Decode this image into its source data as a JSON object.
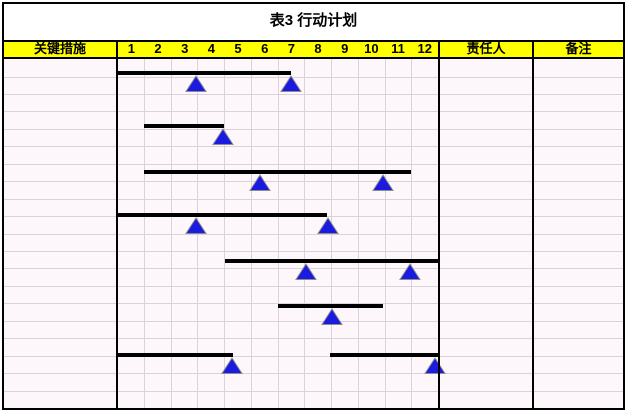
{
  "title": "表3 行动计划",
  "header": {
    "measures_label": "关键措施",
    "months": [
      "1",
      "2",
      "3",
      "4",
      "5",
      "6",
      "7",
      "8",
      "9",
      "10",
      "11",
      "12"
    ],
    "owner_label": "责任人",
    "notes_label": "备注"
  },
  "colors": {
    "header_bg": "#ffff00",
    "body_bg": "#fdf7fb",
    "grid_line": "#d9d2d9",
    "border": "#000000",
    "bar": "#000000",
    "triangle_fill": "#1a1ae0",
    "triangle_stroke": "#8c8c8c"
  },
  "chart_data": {
    "type": "gantt",
    "title": "表3 行动计划",
    "x_axis": {
      "tick_labels": [
        "1",
        "2",
        "3",
        "4",
        "5",
        "6",
        "7",
        "8",
        "9",
        "10",
        "11",
        "12"
      ],
      "range": [
        0,
        12
      ],
      "unit": "month"
    },
    "grid": "on",
    "tasks": [
      {
        "segments": [
          {
            "from": 0,
            "to": 6.5,
            "style": "solid"
          },
          {
            "from": 6.5,
            "to": 11.95,
            "style": "dashed"
          }
        ],
        "milestones": [
          2.95,
          6.5
        ],
        "y_px": 12
      },
      {
        "segments": [
          {
            "from": 1,
            "to": 4,
            "style": "solid"
          }
        ],
        "milestones": [
          3.95
        ],
        "y_px": 65
      },
      {
        "segments": [
          {
            "from": 1,
            "to": 11,
            "style": "solid"
          }
        ],
        "milestones": [
          5.35,
          9.95
        ],
        "y_px": 111
      },
      {
        "segments": [
          {
            "from": 0,
            "to": 7.85,
            "style": "solid"
          }
        ],
        "milestones": [
          2.95,
          7.9
        ],
        "y_px": 154
      },
      {
        "segments": [
          {
            "from": 4.05,
            "to": 12,
            "style": "solid"
          }
        ],
        "milestones": [
          7.05,
          10.95
        ],
        "y_px": 200
      },
      {
        "segments": [
          {
            "from": 6,
            "to": 9.95,
            "style": "solid"
          }
        ],
        "milestones": [
          8.05
        ],
        "y_px": 245
      },
      {
        "segments": [
          {
            "from": 0,
            "to": 4.35,
            "style": "solid"
          },
          {
            "from": 4.35,
            "to": 7.95,
            "style": "dashed"
          },
          {
            "from": 7.95,
            "to": 12,
            "style": "solid"
          }
        ],
        "milestones": [
          4.3,
          11.9
        ],
        "y_px": 294
      }
    ],
    "empty_columns": [
      "关键措施",
      "责任人",
      "备注"
    ]
  }
}
